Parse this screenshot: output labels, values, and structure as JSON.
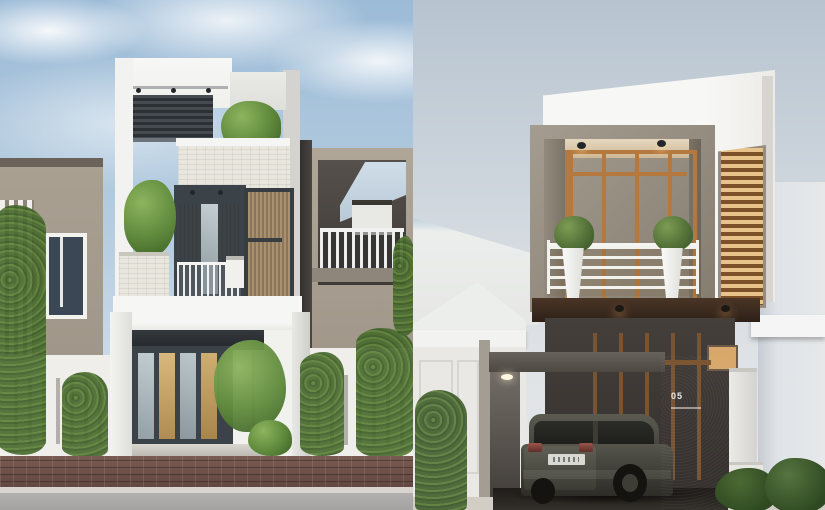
{
  "meta": {
    "type": "side-by-side architectural exterior 3D renders",
    "visible_text": [
      "05"
    ]
  },
  "left_render": {
    "subject": "three-story narrow modern white townhouse with rooftop pergola and tree, stone-clad bands, wood-louver panels, glass entry doors, slatted white fences with climbing vines, brick sidewalk and gray road, taupe neighbor houses",
    "palette": {
      "sky_top": "#9cbbd7",
      "sky_bottom": "#e2ebf1",
      "cloud": "#f4f8fa",
      "facade_white": "#f3f3f1",
      "facade_shade": "#dededa",
      "neighbor_taupe": "#a89e90",
      "pergola_slats": "#353b41",
      "stone_clad": "#e9e6de",
      "wood_slats": "#a8916f",
      "window_frame": "#3c4348",
      "glass_cool": "#b9c4c9",
      "glass_warm": "#c9a86a",
      "foliage": "#679543",
      "foliage_dark": "#45632c",
      "fence_white": "#efeeea",
      "paving_brick": "#6e5148",
      "curb": "#d8d5d0",
      "road": "#aaa8a6"
    }
  },
  "right_render": {
    "subject": "two-story modern house with projecting taupe-framed glowing box, wood-framed glass wall, balcony with white planters, slatted light screen, carport with dark SUV, number wall, white gable neighbor and hedge",
    "house_number": "05",
    "palette": {
      "sky_top": "#b7c4d0",
      "sky_bottom": "#e9eaea",
      "volume_white": "#f6f6f4",
      "box_frame": "#958c80",
      "glass_glow": "#ecd2a2",
      "wood_frame": "#b5793f",
      "louver_light": "#e7c28a",
      "louver_dark": "#7d5128",
      "soffit_dark": "#3a2a1c",
      "wall_charcoal": "#3b3734",
      "pillar_dark": "#45413d",
      "fence_white": "#e5e4e0",
      "neighbor_pale": "#dfe3e8",
      "gable_white": "#eceeec",
      "hedge_green": "#44622f",
      "car_body": "#4a493f",
      "car_glass": "#20211c",
      "plate": "#d8d8d2",
      "tail_light": "#8a4038",
      "ground": "#d2cdc5",
      "carport_floor": "#2a2724"
    }
  }
}
